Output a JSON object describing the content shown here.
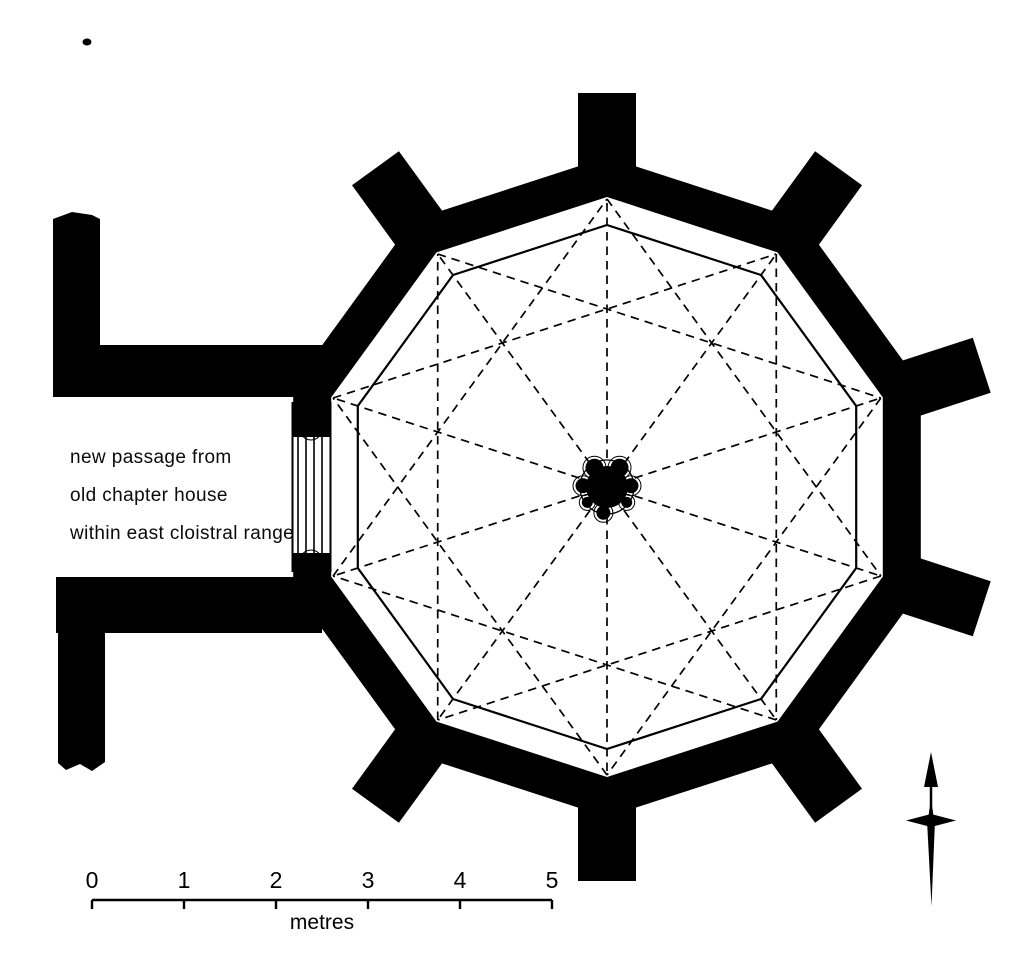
{
  "annotation": {
    "line1": "new passage from",
    "line2": "old chapter house",
    "line3": "within east cloistral range"
  },
  "scale_bar": {
    "ticks": [
      "0",
      "1",
      "2",
      "3",
      "4",
      "5"
    ],
    "unit_label": "metres"
  },
  "colors": {
    "ink": "#000000",
    "paper": "#ffffff"
  },
  "plan": {
    "center": {
      "x": 607,
      "y": 487
    },
    "sides": 10,
    "start_angle_deg": 90,
    "wall_outer_radius": 330,
    "wall_inner_radius": 290,
    "bench_radius": 262,
    "rib_outer_radius": 288,
    "rib_chord_skip": 3,
    "rib_dash": "8.5 6",
    "rib_width": 1.7,
    "bench_stroke": 2.2,
    "pier": {
      "core_radius": 21,
      "outline_radius": 27,
      "lobes": [
        {
          "a": 57,
          "d": 23,
          "r": 9
        },
        {
          "a": 123,
          "d": 23,
          "r": 9
        },
        {
          "a": 3,
          "d": 24,
          "r": 7.5
        },
        {
          "a": 177,
          "d": 24,
          "r": 7.5
        },
        {
          "a": 262,
          "d": 26,
          "r": 7
        },
        {
          "a": 218,
          "d": 25,
          "r": 5.5
        },
        {
          "a": 322,
          "d": 25,
          "r": 5.5
        }
      ]
    },
    "buttresses": {
      "angles": [
        90,
        54,
        18,
        -18,
        -54,
        -90,
        -126,
        126
      ],
      "inner_r": 315,
      "outer_r": 394,
      "half_width": 29
    },
    "passage": {
      "top_wall": {
        "x": 56,
        "y": 345,
        "w": 266,
        "h": 52
      },
      "bottom_wall": {
        "x": 56,
        "y": 577,
        "w": 266,
        "h": 56
      },
      "west_bar_top": [
        [
          53,
          219
        ],
        [
          72,
          212
        ],
        [
          92,
          215
        ],
        [
          100,
          219
        ],
        [
          100,
          397
        ],
        [
          53,
          397
        ]
      ],
      "west_bar_bottom": [
        [
          58,
          577
        ],
        [
          105,
          577
        ],
        [
          105,
          762
        ],
        [
          92,
          771
        ],
        [
          80,
          764
        ],
        [
          66,
          770
        ],
        [
          58,
          763
        ]
      ]
    },
    "door": {
      "clear": {
        "x": 286,
        "y": 437,
        "w": 46,
        "h": 116
      },
      "face_x": [
        292.5,
        330.5
      ],
      "face_y1": 402,
      "face_y2": 572,
      "shaft_x": [
        298,
        306,
        314,
        322
      ],
      "shaft_y1": 437,
      "shaft_y2": 553,
      "top_jamb": {
        "flare": [
          [
            296,
            400
          ],
          [
            327,
            400
          ],
          [
            321,
            421
          ],
          [
            301,
            421
          ]
        ],
        "knob": {
          "cx": 311,
          "cy": 429,
          "r": 8
        }
      },
      "bottom_jamb": {
        "flare": [
          [
            296,
            590
          ],
          [
            327,
            590
          ],
          [
            321,
            569
          ],
          [
            301,
            569
          ]
        ],
        "knob": {
          "cx": 311,
          "cy": 561,
          "r": 8
        }
      }
    },
    "scale_bar_geom": {
      "x1": 92,
      "x2": 552,
      "y": 900,
      "tick_len": 9,
      "num_y": 888,
      "unit_y": 929,
      "num_font": 23,
      "unit_font": 21,
      "stroke": 2.4
    },
    "north_arrow": {
      "x": 931,
      "tip_y": 752,
      "head_base_y": 787,
      "head_half": 7,
      "shaft_top": 781,
      "shaft_bottom": 807,
      "cross_y": 820.5,
      "cross_half_w": 25,
      "cross_half_t": 6.5,
      "tail_y": 906
    },
    "stray_mark": {
      "cx": 87,
      "cy": 42,
      "rx": 4.5,
      "ry": 3.5
    }
  }
}
